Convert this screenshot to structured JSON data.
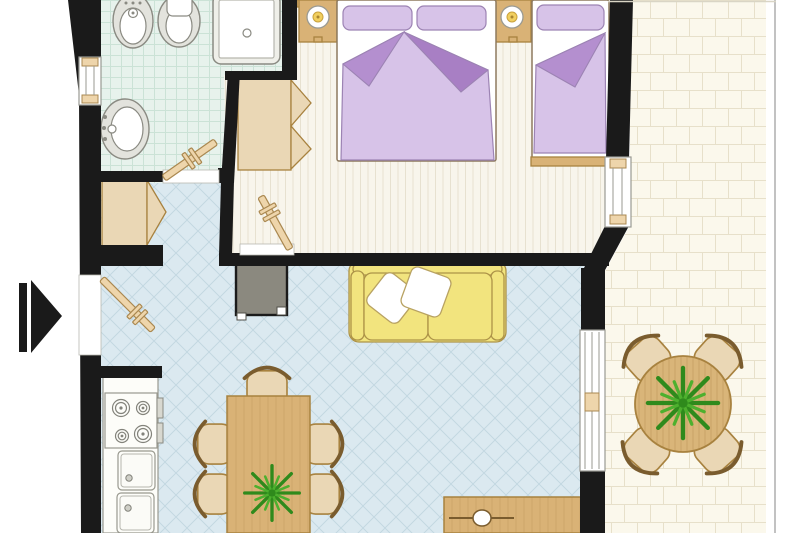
{
  "title": "apartment-floor-plan",
  "colors": {
    "wall": "#1a1a1a",
    "white": "#ffffff",
    "bath-floor": "#e7f2ec",
    "bath-grid": "#cbe2d6",
    "bed-floor": "#f8f5ec",
    "bed-stripe": "#e7e1d0",
    "liv-floor": "#dbe9f0",
    "liv-grid": "#c2d7e1",
    "bal-floor": "#fbf8ec",
    "bal-line": "#e7e0ca",
    "wood": "#d9b276",
    "wood-dark": "#a8823f",
    "wood-deep": "#7a5c2e",
    "wood-light": "#ead7b5",
    "table-wood": "#d9b579",
    "linen": "#d7c3e8",
    "linen-dark": "#b48fcf",
    "linen-dark2": "#a87fc4",
    "linen-line": "#9c83b3",
    "matt-line": "#8d7a5f",
    "sofa": "#f2e47e",
    "sofa-line": "#ad9348",
    "plant": "#4db02e",
    "plant-dark": "#2f8a1c",
    "tv": "#8b897f",
    "fixture": "#e3e3dd",
    "fix-line": "#8a8a82",
    "frame-gray": "#9a9a92",
    "door-leaf": "#eed5ab",
    "door-line": "#aa8850",
    "railing": "#c2c2c2"
  },
  "rooms": [
    {
      "id": "bathroom"
    },
    {
      "id": "bedroom"
    },
    {
      "id": "living-room"
    },
    {
      "id": "entry-hall"
    },
    {
      "id": "kitchen"
    },
    {
      "id": "dining-area"
    },
    {
      "id": "balcony"
    }
  ],
  "furniture": [
    "bidet",
    "toilet",
    "shower",
    "washbasin",
    "double-bed",
    "single-bed",
    "nightstand",
    "bed-lamp",
    "wardrobe",
    "entry-closet",
    "tv-unit",
    "sofa",
    "sofa-cushion",
    "kitchen-counter",
    "stove",
    "kitchen-sink",
    "dining-table",
    "dining-chair",
    "table-plant",
    "sideboard",
    "balcony-table",
    "balcony-chair",
    "balcony-plant",
    "entrance-arrow",
    "window",
    "door"
  ]
}
